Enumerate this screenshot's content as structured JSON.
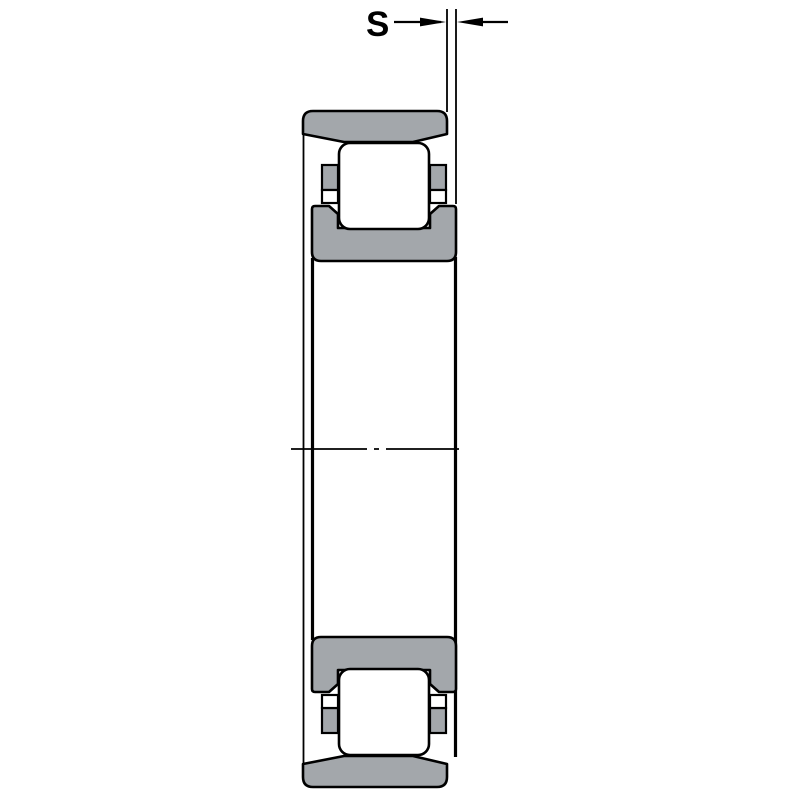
{
  "diagram": {
    "type": "technical-drawing",
    "subject": "cylindrical-roller-bearing-cross-section",
    "dimension": {
      "label": "S",
      "measures": "axial-offset-between-outer-ring-face-and-inner-ring-face"
    },
    "colors": {
      "ring_fill": "#a3a7ab",
      "roller_fill": "#ffffff",
      "line": "#000000",
      "background": "#ffffff"
    }
  }
}
